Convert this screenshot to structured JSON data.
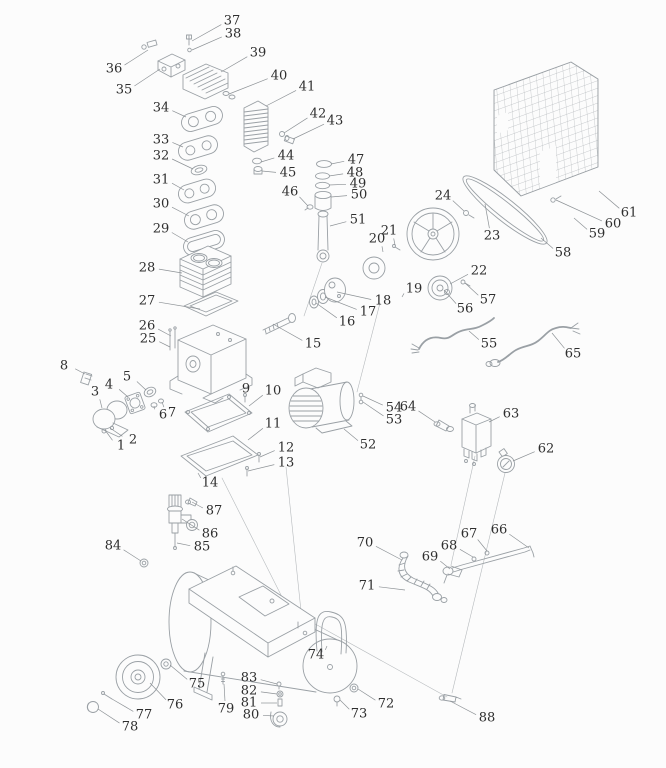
{
  "diagram": {
    "type": "exploded-parts-diagram",
    "subject": "air-compressor",
    "style": {
      "background": "#fcfcfc",
      "line_color": "#9aa0a5",
      "light_line_color": "#b6babd",
      "leader_color": "#8d9296",
      "label_color": "#2e2e2e"
    },
    "parts": [
      {
        "num": "1",
        "x": 121,
        "y": 446,
        "tx": 105,
        "ty": 430
      },
      {
        "num": "2",
        "x": 133,
        "y": 440,
        "tx": 110,
        "ty": 428
      },
      {
        "num": "3",
        "x": 95,
        "y": 392,
        "tx": 102,
        "ty": 408
      },
      {
        "num": "4",
        "x": 109,
        "y": 385,
        "tx": 128,
        "ty": 397
      },
      {
        "num": "5",
        "x": 127,
        "y": 377,
        "tx": 146,
        "ty": 390
      },
      {
        "num": "6",
        "x": 163,
        "y": 415,
        "tx": 154,
        "ty": 406
      },
      {
        "num": "7",
        "x": 172,
        "y": 413,
        "tx": 162,
        "ty": 402
      },
      {
        "num": "8",
        "x": 64,
        "y": 366,
        "tx": 85,
        "ty": 374
      },
      {
        "num": "9",
        "x": 246,
        "y": 389,
        "tx": 245,
        "ty": 397
      },
      {
        "num": "10",
        "x": 273,
        "y": 391,
        "tx": 249,
        "ty": 406
      },
      {
        "num": "11",
        "x": 273,
        "y": 424,
        "tx": 248,
        "ty": 440
      },
      {
        "num": "12",
        "x": 286,
        "y": 448,
        "tx": 260,
        "ty": 457
      },
      {
        "num": "13",
        "x": 286,
        "y": 463,
        "tx": 248,
        "ty": 471
      },
      {
        "num": "14",
        "x": 210,
        "y": 483,
        "tx": 198,
        "ty": 473
      },
      {
        "num": "15",
        "x": 313,
        "y": 344,
        "tx": 273,
        "ty": 324
      },
      {
        "num": "16",
        "x": 347,
        "y": 322,
        "tx": 316,
        "ty": 303
      },
      {
        "num": "17",
        "x": 368,
        "y": 312,
        "tx": 325,
        "ty": 297
      },
      {
        "num": "18",
        "x": 383,
        "y": 301,
        "tx": 337,
        "ty": 292
      },
      {
        "num": "19",
        "x": 414,
        "y": 289,
        "tx": 402,
        "ty": 297
      },
      {
        "num": "20",
        "x": 377,
        "y": 239,
        "tx": 383,
        "ty": 252
      },
      {
        "num": "21",
        "x": 389,
        "y": 231,
        "tx": 395,
        "ty": 245
      },
      {
        "num": "22",
        "x": 479,
        "y": 271,
        "tx": 450,
        "ty": 284
      },
      {
        "num": "23",
        "x": 492,
        "y": 236,
        "tx": 485,
        "ty": 204
      },
      {
        "num": "24",
        "x": 443,
        "y": 196,
        "tx": 464,
        "ty": 211
      },
      {
        "num": "25",
        "x": 148,
        "y": 339,
        "tx": 170,
        "ty": 347
      },
      {
        "num": "26",
        "x": 147,
        "y": 326,
        "tx": 171,
        "ty": 336
      },
      {
        "num": "27",
        "x": 147,
        "y": 301,
        "tx": 200,
        "ty": 309
      },
      {
        "num": "28",
        "x": 147,
        "y": 268,
        "tx": 182,
        "ty": 273
      },
      {
        "num": "29",
        "x": 161,
        "y": 229,
        "tx": 188,
        "ty": 242
      },
      {
        "num": "30",
        "x": 161,
        "y": 204,
        "tx": 189,
        "ty": 216
      },
      {
        "num": "31",
        "x": 161,
        "y": 180,
        "tx": 184,
        "ty": 190
      },
      {
        "num": "32",
        "x": 161,
        "y": 156,
        "tx": 193,
        "ty": 169
      },
      {
        "num": "33",
        "x": 161,
        "y": 140,
        "tx": 183,
        "ty": 147
      },
      {
        "num": "34",
        "x": 161,
        "y": 108,
        "tx": 186,
        "ty": 117
      },
      {
        "num": "35",
        "x": 124,
        "y": 90,
        "tx": 160,
        "ty": 69
      },
      {
        "num": "36",
        "x": 114,
        "y": 69,
        "tx": 148,
        "ty": 50
      },
      {
        "num": "37",
        "x": 232,
        "y": 21,
        "tx": 192,
        "ty": 41
      },
      {
        "num": "38",
        "x": 233,
        "y": 34,
        "tx": 192,
        "ty": 50
      },
      {
        "num": "39",
        "x": 258,
        "y": 53,
        "tx": 221,
        "ty": 72
      },
      {
        "num": "40",
        "x": 279,
        "y": 76,
        "tx": 229,
        "ty": 94
      },
      {
        "num": "41",
        "x": 307,
        "y": 87,
        "tx": 266,
        "ty": 106
      },
      {
        "num": "42",
        "x": 318,
        "y": 114,
        "tx": 284,
        "ty": 133
      },
      {
        "num": "43",
        "x": 335,
        "y": 121,
        "tx": 293,
        "ty": 139
      },
      {
        "num": "44",
        "x": 286,
        "y": 156,
        "tx": 261,
        "ty": 162
      },
      {
        "num": "45",
        "x": 288,
        "y": 173,
        "tx": 262,
        "ty": 171
      },
      {
        "num": "46",
        "x": 290,
        "y": 192,
        "tx": 308,
        "ty": 206
      },
      {
        "num": "47",
        "x": 356,
        "y": 160,
        "tx": 331,
        "ty": 164
      },
      {
        "num": "48",
        "x": 355,
        "y": 173,
        "tx": 329,
        "ty": 176
      },
      {
        "num": "49",
        "x": 358,
        "y": 184,
        "tx": 329,
        "ty": 185
      },
      {
        "num": "50",
        "x": 359,
        "y": 195,
        "tx": 331,
        "ty": 197
      },
      {
        "num": "51",
        "x": 358,
        "y": 220,
        "tx": 330,
        "ty": 226
      },
      {
        "num": "52",
        "x": 368,
        "y": 445,
        "tx": 344,
        "ty": 429
      },
      {
        "num": "53",
        "x": 394,
        "y": 420,
        "tx": 363,
        "ty": 402
      },
      {
        "num": "54",
        "x": 394,
        "y": 408,
        "tx": 363,
        "ty": 396
      },
      {
        "num": "55",
        "x": 489,
        "y": 344,
        "tx": 469,
        "ty": 331
      },
      {
        "num": "56",
        "x": 465,
        "y": 309,
        "tx": 444,
        "ty": 290
      },
      {
        "num": "57",
        "x": 488,
        "y": 300,
        "tx": 465,
        "ty": 283
      },
      {
        "num": "58",
        "x": 563,
        "y": 253,
        "tx": 541,
        "ty": 238
      },
      {
        "num": "59",
        "x": 597,
        "y": 234,
        "tx": 574,
        "ty": 218
      },
      {
        "num": "60",
        "x": 613,
        "y": 224,
        "tx": 556,
        "ty": 200
      },
      {
        "num": "61",
        "x": 629,
        "y": 213,
        "tx": 599,
        "ty": 191
      },
      {
        "num": "62",
        "x": 546,
        "y": 449,
        "tx": 513,
        "ty": 461
      },
      {
        "num": "63",
        "x": 511,
        "y": 414,
        "tx": 489,
        "ty": 422
      },
      {
        "num": "64",
        "x": 408,
        "y": 407,
        "tx": 435,
        "ty": 422
      },
      {
        "num": "65",
        "x": 573,
        "y": 354,
        "tx": 552,
        "ty": 333
      },
      {
        "num": "66",
        "x": 499,
        "y": 530,
        "tx": 529,
        "ty": 548
      },
      {
        "num": "67",
        "x": 469,
        "y": 534,
        "tx": 487,
        "ty": 551
      },
      {
        "num": "68",
        "x": 449,
        "y": 546,
        "tx": 473,
        "ty": 557
      },
      {
        "num": "69",
        "x": 430,
        "y": 557,
        "tx": 450,
        "ty": 569
      },
      {
        "num": "70",
        "x": 365,
        "y": 543,
        "tx": 402,
        "ty": 560
      },
      {
        "num": "71",
        "x": 367,
        "y": 586,
        "tx": 405,
        "ty": 590
      },
      {
        "num": "72",
        "x": 386,
        "y": 704,
        "tx": 358,
        "ty": 689
      },
      {
        "num": "73",
        "x": 359,
        "y": 714,
        "tx": 340,
        "ty": 700
      },
      {
        "num": "74",
        "x": 316,
        "y": 655,
        "tx": 327,
        "ty": 646
      },
      {
        "num": "75",
        "x": 197,
        "y": 684,
        "tx": 170,
        "ty": 665
      },
      {
        "num": "76",
        "x": 175,
        "y": 705,
        "tx": 150,
        "ty": 683
      },
      {
        "num": "77",
        "x": 144,
        "y": 715,
        "tx": 112,
        "ty": 699
      },
      {
        "num": "78",
        "x": 130,
        "y": 727,
        "tx": 98,
        "ty": 709
      },
      {
        "num": "79",
        "x": 226,
        "y": 709,
        "tx": 224,
        "ty": 684
      },
      {
        "num": "80",
        "x": 251,
        "y": 715,
        "tx": 274,
        "ty": 716
      },
      {
        "num": "81",
        "x": 249,
        "y": 703,
        "tx": 277,
        "ty": 703
      },
      {
        "num": "82",
        "x": 249,
        "y": 691,
        "tx": 277,
        "ty": 694
      },
      {
        "num": "83",
        "x": 249,
        "y": 678,
        "tx": 277,
        "ty": 684
      },
      {
        "num": "84",
        "x": 113,
        "y": 546,
        "tx": 141,
        "ty": 561
      },
      {
        "num": "85",
        "x": 202,
        "y": 547,
        "tx": 177,
        "ty": 543
      },
      {
        "num": "86",
        "x": 210,
        "y": 534,
        "tx": 182,
        "ty": 519
      },
      {
        "num": "87",
        "x": 214,
        "y": 511,
        "tx": 192,
        "ty": 502
      },
      {
        "num": "88",
        "x": 487,
        "y": 718,
        "tx": 450,
        "ty": 701
      }
    ]
  }
}
